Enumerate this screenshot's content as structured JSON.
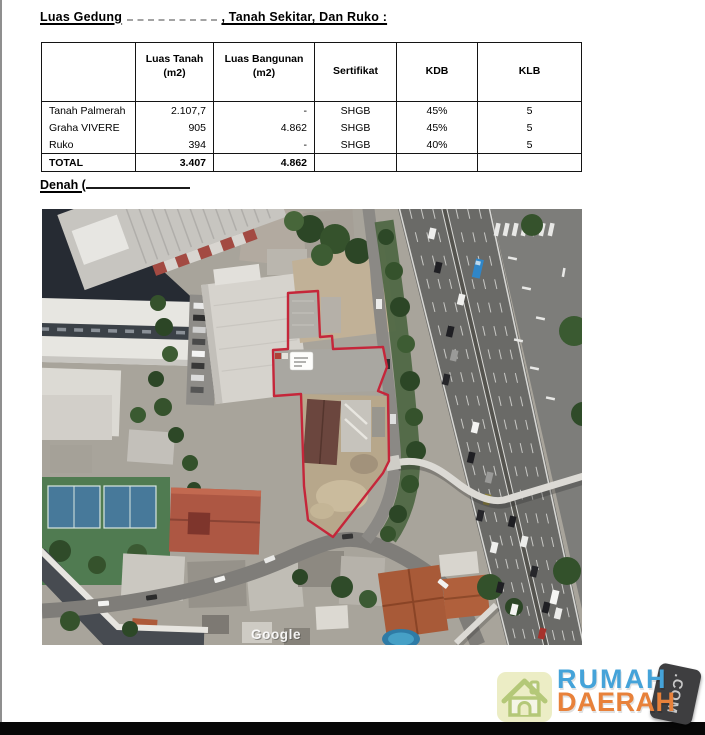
{
  "document": {
    "title": {
      "lead": "Luas Gedung",
      "tail": ", Tanah Sekitar, Dan Ruko :"
    },
    "denah_label": "Denah ("
  },
  "table": {
    "headers": [
      {
        "line1": "",
        "line2": ""
      },
      {
        "line1": "Luas Tanah",
        "line2": "(m2)"
      },
      {
        "line1": "Luas Bangunan",
        "line2": "(m2)"
      },
      {
        "line1": "Sertifikat",
        "line2": ""
      },
      {
        "line1": "KDB",
        "line2": ""
      },
      {
        "line1": "KLB",
        "line2": ""
      }
    ],
    "rows": [
      [
        "Tanah Palmerah",
        "2.107,7",
        "-",
        "SHGB",
        "45%",
        "5"
      ],
      [
        "Graha VIVERE",
        "905",
        "4.862",
        "SHGB",
        "45%",
        "5"
      ],
      [
        "Ruko",
        "394",
        "-",
        "SHGB",
        "40%",
        "5"
      ]
    ],
    "total": [
      "TOTAL",
      "3.407",
      "4.862",
      "",
      "",
      ""
    ]
  },
  "map": {
    "google_watermark": "Google",
    "boundary_color": "#c5263a"
  },
  "branding": {
    "word_top": "RUMAH",
    "word_bottom": "DAERAH",
    "tld": ".COM",
    "color_top": "#45a3d9",
    "color_bottom": "#e8813a"
  }
}
